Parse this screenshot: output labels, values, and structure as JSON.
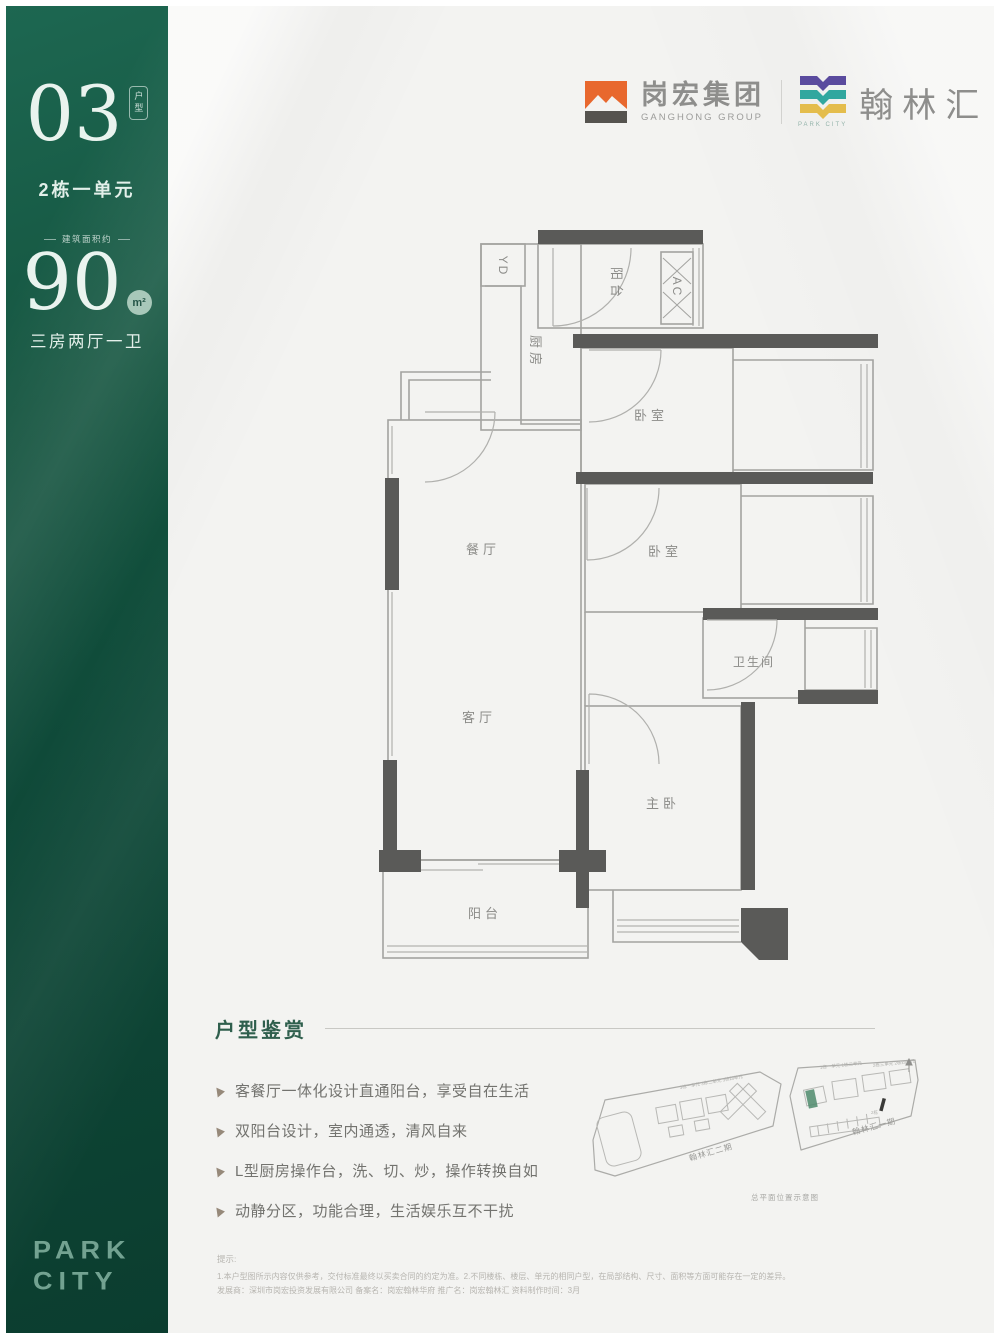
{
  "sidebar": {
    "unit_number": "03",
    "unit_badge": "户型",
    "unit_line": "2栋一单元",
    "area_label": "建筑面积约",
    "area_number": "90",
    "area_unit": "m²",
    "layout_line": "三房两厅一卫",
    "brand_line1": "PARK",
    "brand_line2": "CITY"
  },
  "header": {
    "group_name": "岗宏集团",
    "group_sub": "GANGHONG GROUP",
    "project_name": "翰林汇",
    "project_sub": "PARK CITY"
  },
  "floorplan": {
    "rooms": [
      {
        "label": "YD"
      },
      {
        "label": "阳台"
      },
      {
        "label": "AC"
      },
      {
        "label": "厨房"
      },
      {
        "label": "卧室"
      },
      {
        "label": "卧室"
      },
      {
        "label": "餐厅"
      },
      {
        "label": "客厅"
      },
      {
        "label": "卫生间"
      },
      {
        "label": "主卧"
      },
      {
        "label": "阳台"
      }
    ]
  },
  "appreciation": {
    "title": "户型鉴赏",
    "bullets": [
      "客餐厅一体化设计直通阳台，享受自在生活",
      "双阳台设计，室内通透，清风自来",
      "L型厨房操作台，洗、切、炒，操作转换自如",
      "动静分区，功能合理，生活娱乐互不干扰"
    ]
  },
  "siteplan": {
    "phase2_label": "翰林汇二期",
    "phase1_label": "翰林汇一期",
    "caption": "总平面位置示意图",
    "tiny_labels_left": "3栋一单元 3栋二单元 3栋四单元",
    "tiny_labels_right1": "1栋一单元 1栋二单元",
    "tiny_labels_right2": "2栋三单元 2栋四单元",
    "marker_label": "2栋"
  },
  "disclaimer": {
    "heading": "提示:",
    "line1": "1.本户型图所示内容仅供参考，交付标准最终以买卖合同的约定为准。2.不同楼栋、楼层、单元的相同户型，在局部结构、尺寸、面积等方面可能存在一定的差异。",
    "line2": "发展商：深圳市岗宏投资发展有限公司 备案名：岗宏翰林华府 推广名：岗宏翰林汇 资料制作时间：3月"
  },
  "colors": {
    "sidebar_green": "#0f4a39",
    "accent_green": "#2f5f4d",
    "logo_orange": "#e8682e",
    "logo_purple": "#5a4b9e",
    "logo_teal": "#31a79f",
    "logo_yellow": "#e4bd4c",
    "highlight_building_green": "#4e8a6c",
    "wall_gray": "#5a5a58"
  }
}
